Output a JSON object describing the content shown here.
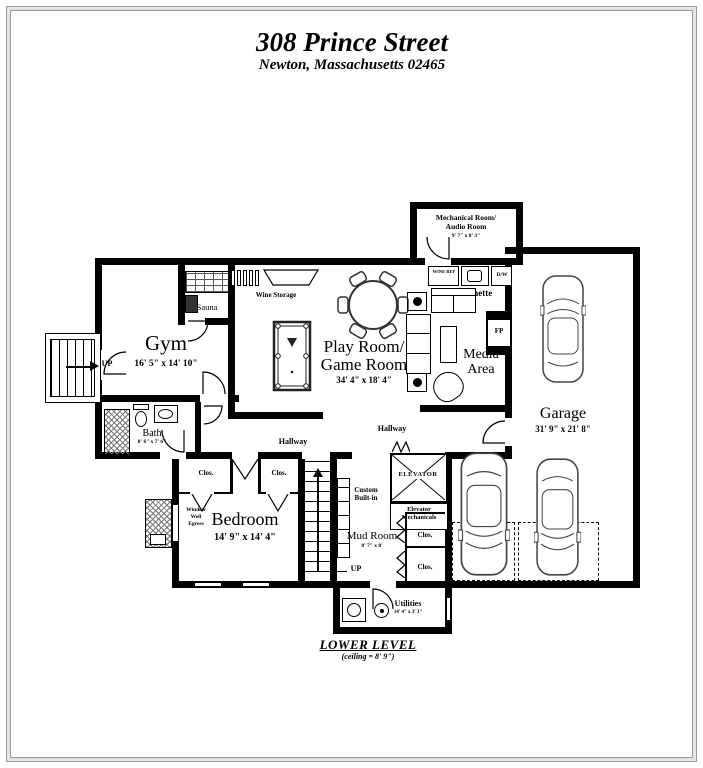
{
  "header": {
    "line1": "308 Prince Street",
    "line2": "Newton, Massachusetts 02465"
  },
  "rooms": {
    "mechanical": {
      "line1": "Mechanical Room/",
      "line2": "Audio Room",
      "dims": "9' 7\" x 8' 3\""
    },
    "kitchenette": {
      "label": "Kitchenette",
      "wine_ref": "WINE REF",
      "dw": "D/W"
    },
    "wine_storage": {
      "label": "Wine Storage"
    },
    "sauna": {
      "label": "Sauna"
    },
    "gym": {
      "label": "Gym",
      "dims": "16' 5\" x 14' 10\""
    },
    "play_room": {
      "line1": "Play Room/",
      "line2": "Game Room",
      "dims": "34' 4\" x 18' 4\""
    },
    "media": {
      "line1": "Media",
      "line2": "Area"
    },
    "fireplace": {
      "label": "FP"
    },
    "garage": {
      "label": "Garage",
      "dims": "31' 9\" x 21' 8\""
    },
    "bath": {
      "label": "Bath",
      "dims": "8' 6\" x 7' 6\""
    },
    "bedroom": {
      "label": "Bedroom",
      "dims": "14' 9\" x 14' 4\""
    },
    "mud_room": {
      "label": "Mud Room",
      "dims": "8' 7\" x 8'"
    },
    "utilities": {
      "label": "Utilities",
      "dims": "14' 4\" x 3' 3\""
    },
    "elevator": {
      "label": "ELEVATOR"
    },
    "elevator_mechanicals": {
      "line1": "Elevator",
      "line2": "Mechanicals"
    },
    "custom_builtin": {
      "line1": "Custom",
      "line2": "Built-in"
    },
    "window_well": {
      "line1": "Window",
      "line2": "Well",
      "line3": "Egress"
    }
  },
  "labels": {
    "hallway": "Hallway",
    "closet": "Clos.",
    "up": "UP"
  },
  "footer": {
    "level": "LOWER LEVEL",
    "ceiling": "(ceiling = 8' 9\")"
  }
}
